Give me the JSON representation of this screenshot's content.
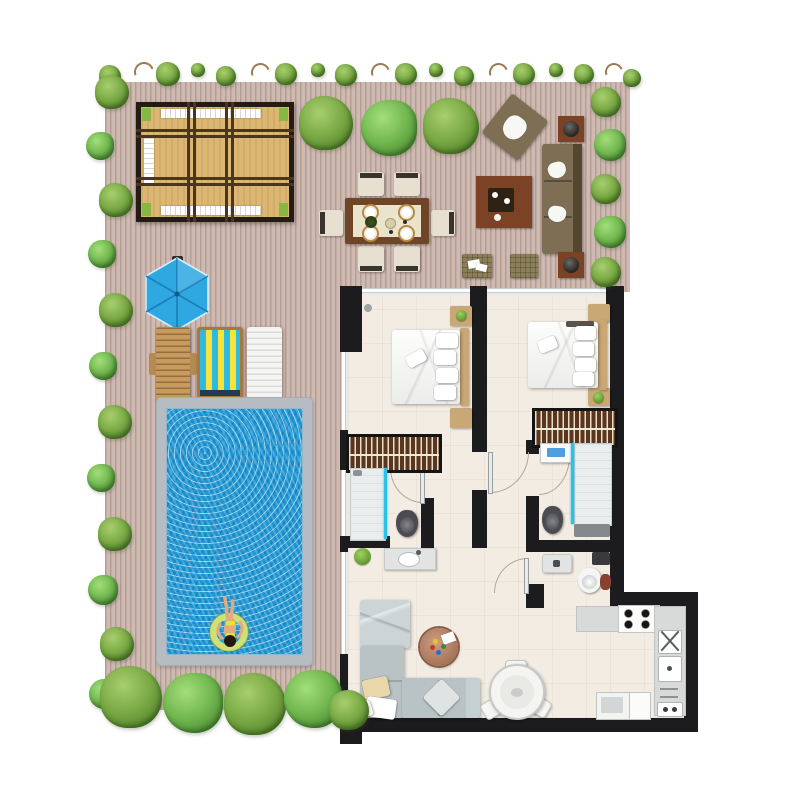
{
  "alt": "Top-down architectural floor plan rendering: outdoor deck with pergola daybed, dining set, lounge set, blue parasol, three sun loungers and a swimming pool with a person on a float, surrounded by trees; interior with two bedrooms, two bathrooms, guest WC, kitchen and living-dining room with black walls",
  "palette": {
    "deck_base": "#cfbab2",
    "deck_stripe": "#b49d95",
    "wall": "#1c1c1e",
    "interior_floor": "#f2ece3",
    "pool_coping": "#b7bcc2",
    "pool_water": "#1d97d3",
    "tree_green": "#79a944",
    "tree_dark": "#4e7b27",
    "tree_light": "#a8ce6e",
    "umbrella_blue": "#2fa7e1",
    "umbrella_rib": "#1a7fb5",
    "canopy_tan": "#dcb673",
    "outdoor_olive": "#7e6e54",
    "lounger_wood": "#c79a5f",
    "stripe_blue": "#2fb9e0",
    "stripe_yellow": "#f7e43a",
    "sofa_grey": "#b9c2c5",
    "wardrobe_brown": "#59361c",
    "headboard_tan": "#c9a876",
    "shower_glass": "#27c3e8",
    "toilet_dark": "#4b4b50",
    "washer_blue": "#4f9fe0",
    "skin": "#e2ab7d",
    "float_ring": "#cfe077"
  },
  "vegetation": {
    "top_border": [
      {
        "x": 110,
        "y": 76,
        "s": 22
      },
      {
        "x": 142,
        "y": 70,
        "s": 16,
        "t": "twig"
      },
      {
        "x": 168,
        "y": 74,
        "s": 24
      },
      {
        "x": 198,
        "y": 70,
        "s": 14
      },
      {
        "x": 226,
        "y": 76,
        "s": 20
      },
      {
        "x": 258,
        "y": 70,
        "s": 15,
        "t": "twig"
      },
      {
        "x": 286,
        "y": 74,
        "s": 22
      },
      {
        "x": 318,
        "y": 70,
        "s": 14
      },
      {
        "x": 346,
        "y": 75,
        "s": 22
      },
      {
        "x": 378,
        "y": 70,
        "s": 15,
        "t": "twig"
      },
      {
        "x": 406,
        "y": 74,
        "s": 22
      },
      {
        "x": 436,
        "y": 70,
        "s": 14
      },
      {
        "x": 464,
        "y": 76,
        "s": 20
      },
      {
        "x": 496,
        "y": 70,
        "s": 15,
        "t": "twig"
      },
      {
        "x": 524,
        "y": 74,
        "s": 22
      },
      {
        "x": 556,
        "y": 70,
        "s": 14
      },
      {
        "x": 584,
        "y": 74,
        "s": 20
      },
      {
        "x": 612,
        "y": 70,
        "s": 14,
        "t": "twig"
      },
      {
        "x": 632,
        "y": 78,
        "s": 18
      }
    ],
    "left_column": [
      {
        "x": 112,
        "y": 92,
        "s": 34
      },
      {
        "x": 100,
        "y": 146,
        "s": 28,
        "v": 1
      },
      {
        "x": 116,
        "y": 200,
        "s": 34
      },
      {
        "x": 102,
        "y": 254,
        "s": 28,
        "v": 1
      },
      {
        "x": 116,
        "y": 310,
        "s": 34
      },
      {
        "x": 103,
        "y": 366,
        "s": 28,
        "v": 1
      },
      {
        "x": 115,
        "y": 422,
        "s": 34
      },
      {
        "x": 101,
        "y": 478,
        "s": 28,
        "v": 1
      },
      {
        "x": 115,
        "y": 534,
        "s": 34
      },
      {
        "x": 103,
        "y": 590,
        "s": 30,
        "v": 1
      },
      {
        "x": 117,
        "y": 644,
        "s": 34
      },
      {
        "x": 104,
        "y": 694,
        "s": 30,
        "v": 1
      }
    ],
    "right_column": [
      {
        "x": 606,
        "y": 102,
        "s": 30
      },
      {
        "x": 610,
        "y": 145,
        "s": 32,
        "v": 1
      },
      {
        "x": 606,
        "y": 189,
        "s": 30
      },
      {
        "x": 610,
        "y": 232,
        "s": 32,
        "v": 1
      },
      {
        "x": 606,
        "y": 272,
        "s": 30
      }
    ],
    "deck_row": [
      {
        "x": 326,
        "y": 123,
        "s": 54
      },
      {
        "x": 389,
        "y": 128,
        "s": 56,
        "v": 1
      },
      {
        "x": 451,
        "y": 126,
        "s": 56
      }
    ],
    "bottom_row": [
      {
        "x": 131,
        "y": 697,
        "s": 62
      },
      {
        "x": 193,
        "y": 703,
        "s": 60,
        "v": 1
      },
      {
        "x": 255,
        "y": 704,
        "s": 62
      },
      {
        "x": 313,
        "y": 699,
        "s": 58,
        "v": 1
      },
      {
        "x": 349,
        "y": 710,
        "s": 40
      }
    ]
  },
  "outdoor_items": {
    "pergola": "pergola daybed",
    "dining": "6-seat outdoor dining set",
    "lounge": "outdoor lounge sofa set",
    "umbrella": "blue parasol",
    "loungers": "three sun loungers",
    "pool": "swimming pool with float"
  },
  "rooms": {
    "bedroom1": "bedroom 1",
    "bedroom2": "bedroom 2",
    "bathroom1": "ensuite bathroom 1",
    "bathroom2": "bathroom 2",
    "wc": "guest wc",
    "kitchen": "kitchen",
    "living": "living-dining room"
  }
}
